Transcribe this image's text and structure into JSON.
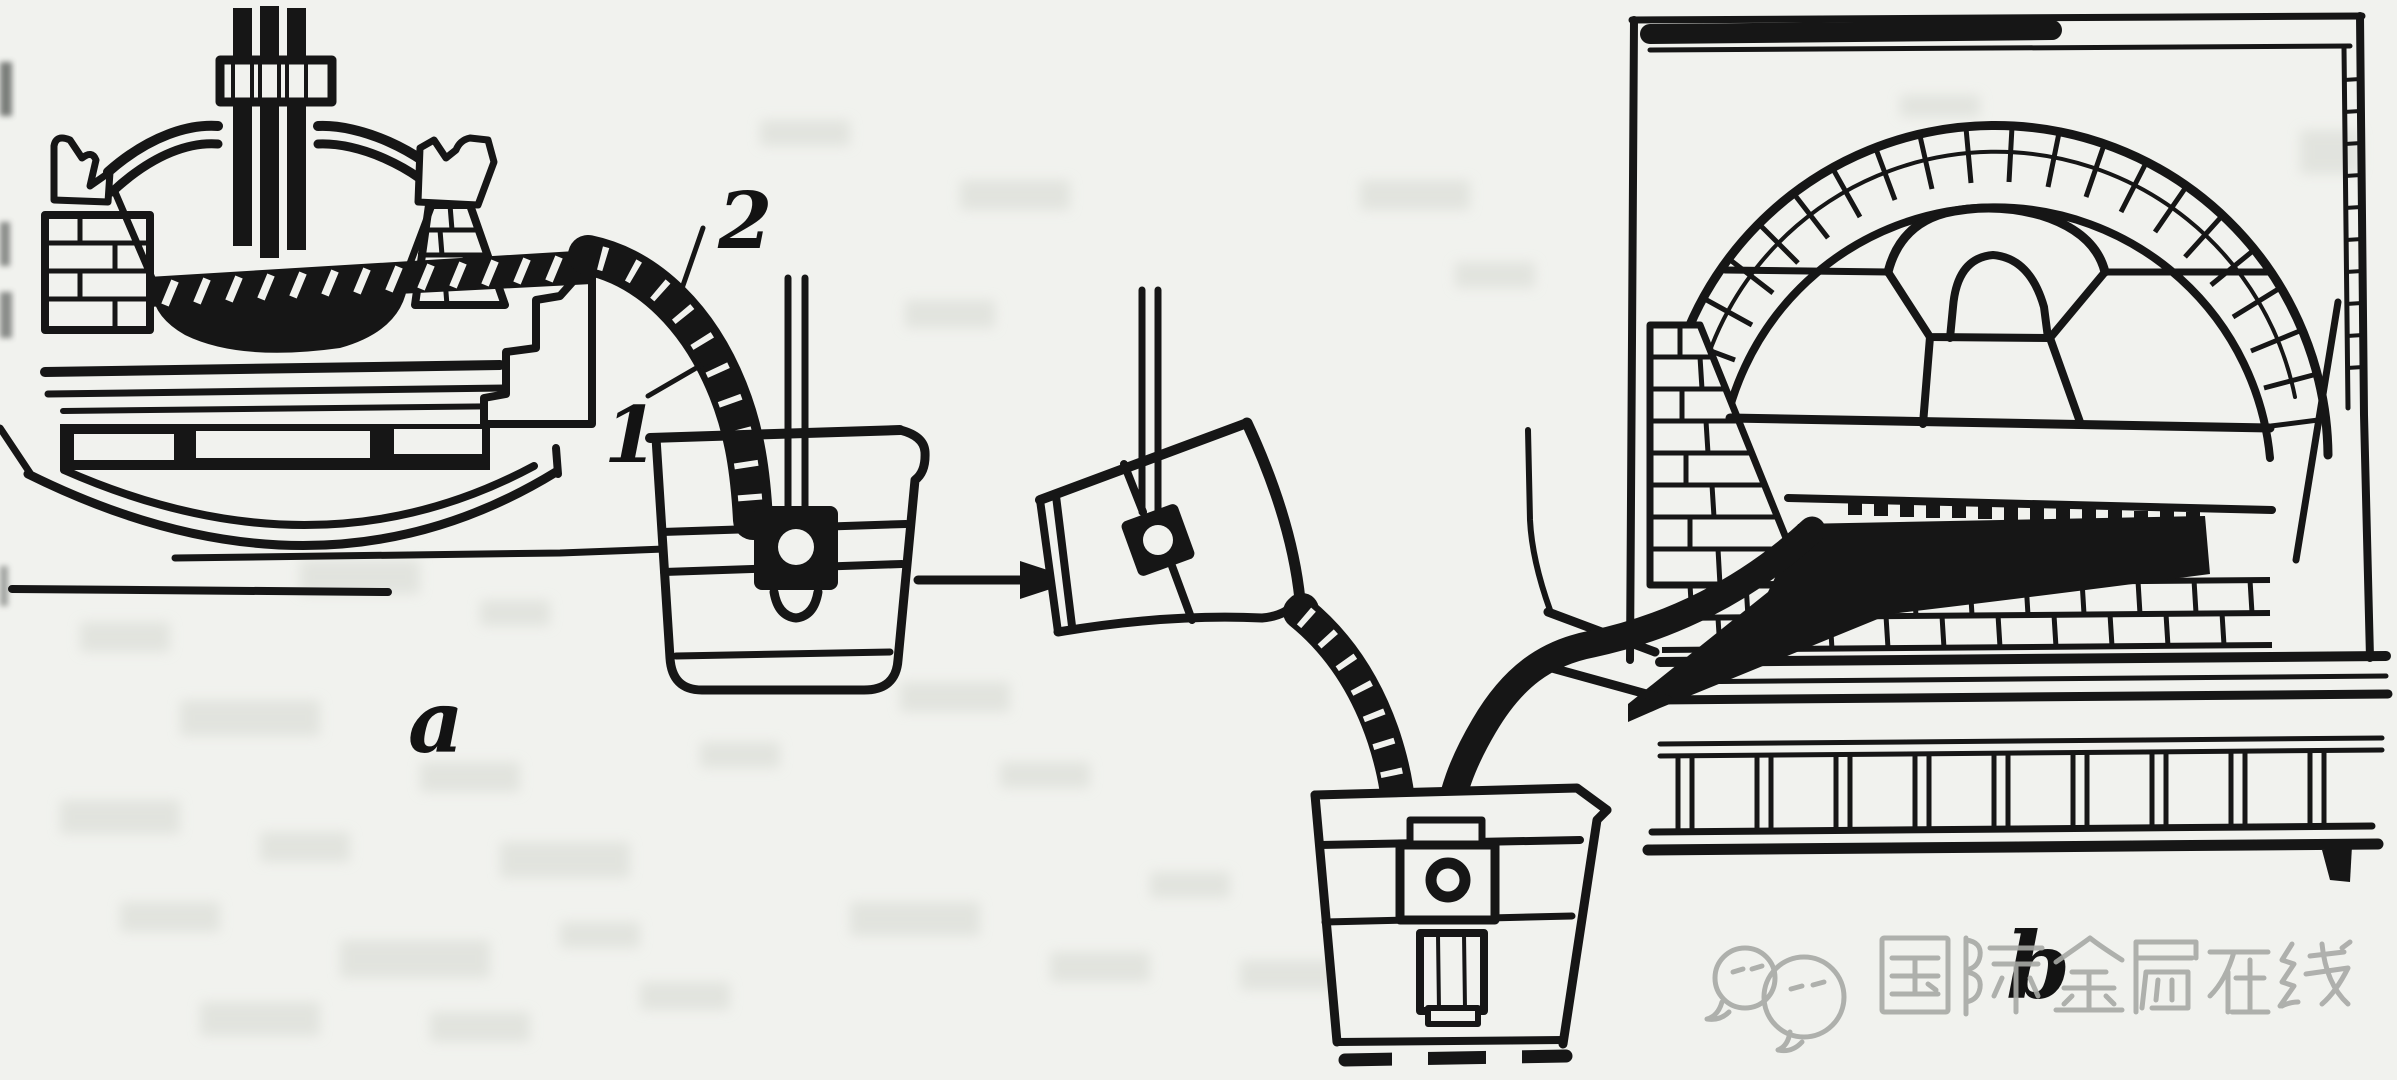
{
  "page": {
    "background_color": "#f1f2ee",
    "ink_color": "#161616",
    "kind": "scanned textbook line diagram (metallurgy: tapping molten steel from furnaces into ladles)"
  },
  "figure": {
    "labels": {
      "panel_a": "a",
      "panel_b": "b",
      "callout_1": "1",
      "callout_2": "2"
    },
    "parts": [
      "electric-arc-furnace",
      "electrodes",
      "slag-stream-hatched",
      "teeming-ladle-upright",
      "transfer-arrow",
      "teeming-ladle-tilted",
      "open-hearth-furnace",
      "tapping-stream",
      "bottom-pour-ladle"
    ],
    "watermark": {
      "logo": "speech-bubbles-icon",
      "text": "国际金属在线",
      "color": "#a7a9a5"
    }
  }
}
